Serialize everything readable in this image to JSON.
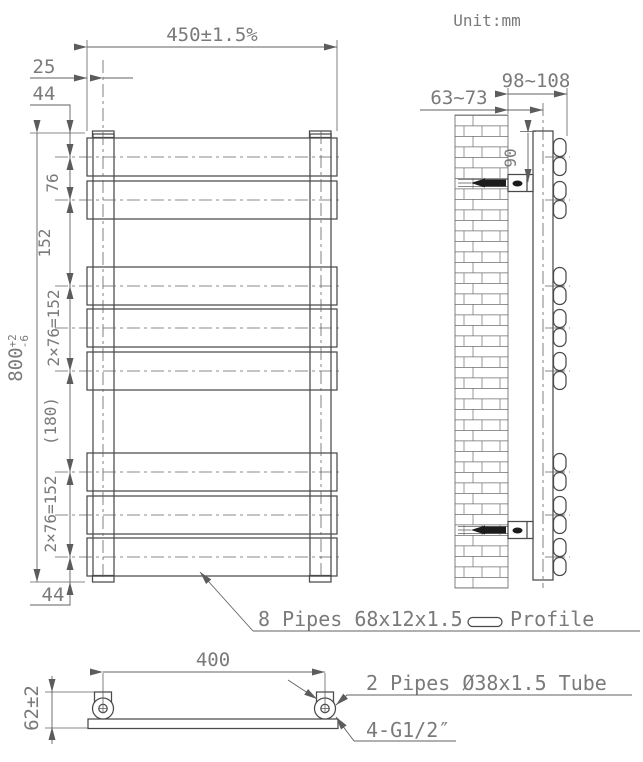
{
  "drawing": {
    "unit_label": "Unit:mm",
    "front": {
      "width_dim": "450±1.5%",
      "tube_offset_dim": "25",
      "top_end_dim": "44",
      "height_dim": "800",
      "height_tol_plus": "+2",
      "height_tol_minus": "-6",
      "chain_dims": [
        "76",
        "152",
        "2×76=152",
        "(180)",
        "2×76=152"
      ],
      "bottom_end_dim": "44",
      "pipes_leader": "8 Pipes 68x12x1.5",
      "profile_label": "Profile"
    },
    "side": {
      "wall_to_center_dim": "63~73",
      "wall_to_face_dim": "98~108",
      "bracket_offset_dim": "90"
    },
    "bottom": {
      "centers_dim": "400",
      "valve_height_dim": "62±2",
      "tube_leader": "2 Pipes Ø38x1.5 Tube",
      "thread_leader": "4-G1/2″"
    }
  }
}
